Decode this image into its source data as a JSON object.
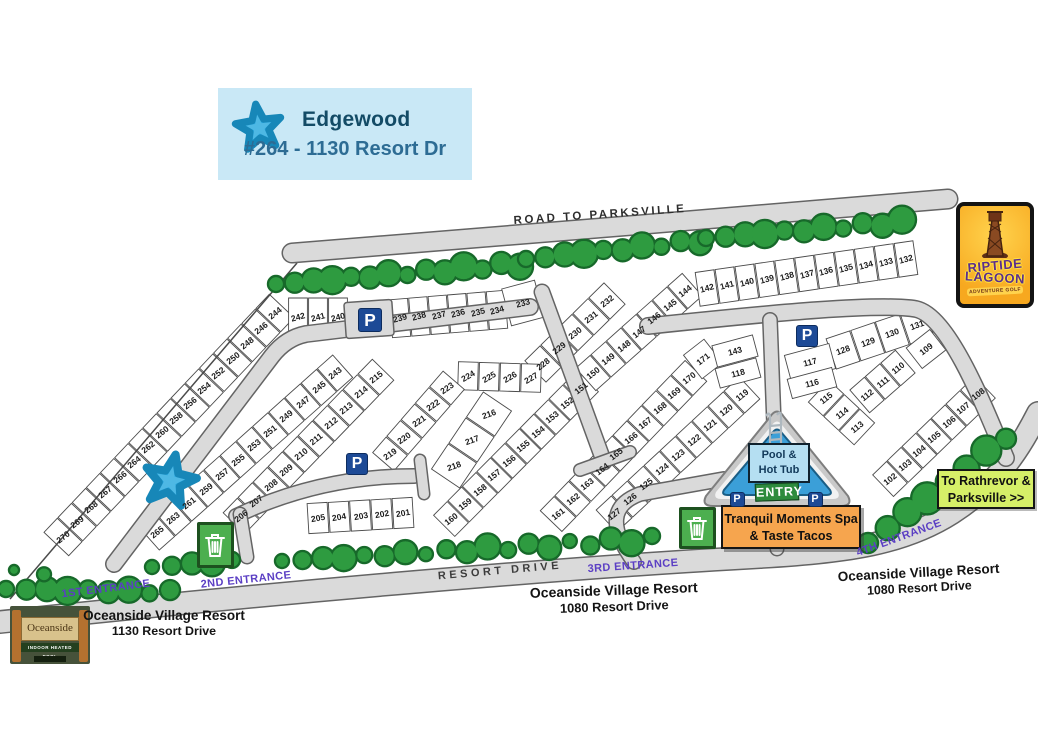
{
  "legend": {
    "name": "Edgewood",
    "unit": "#264 - 1130 Resort Dr"
  },
  "road_labels": {
    "top": "ROAD TO PARKSVILLE",
    "bottom": "RESORT DRIVE"
  },
  "entrances": [
    {
      "label": "1ST ENTRANCE",
      "x": 106,
      "y": 589,
      "rot": -7
    },
    {
      "label": "2ND ENTRANCE",
      "x": 246,
      "y": 580,
      "rot": -6
    },
    {
      "label": "3RD ENTRANCE",
      "x": 633,
      "y": 566,
      "rot": -4
    },
    {
      "label": "4TH ENTRANCE",
      "x": 899,
      "y": 538,
      "rot": -20
    }
  ],
  "addresses": [
    {
      "line1": "Oceanside Village Resort",
      "line2": "1130 Resort Drive",
      "x": 164,
      "y": 608,
      "rot": 0,
      "size": 13.5
    },
    {
      "line1": "Oceanside Village Resort",
      "line2": "1080 Resort Drive",
      "x": 614,
      "y": 582,
      "rot": -2,
      "size": 14
    },
    {
      "line1": "Oceanside Village Resort",
      "line2": "1080 Resort Drive",
      "x": 919,
      "y": 565,
      "rot": -3,
      "size": 13.5
    }
  ],
  "signs": {
    "entry": {
      "label": "ENTRY"
    },
    "pool": {
      "line1": "Pool &",
      "line2": "Hot Tub"
    },
    "spa": {
      "line1": "Tranquil Moments Spa",
      "line2": "& Taste Tacos"
    },
    "rathrevor": {
      "line1": "To Rathrevor &",
      "line2": "Parksville >>"
    },
    "riptide": {
      "line1": "RIPTIDE",
      "line2": "LAGOON",
      "line3": "ADVENTURE GOLF"
    },
    "oceanside_photo": {
      "title": "Oceanside",
      "line2": "INDOOR HEATED POOL"
    }
  },
  "strips": [
    {
      "id": "outer-west",
      "x1": 275,
      "y1": 313,
      "x2": 63,
      "y2": 537,
      "depth": 34,
      "rot": -38,
      "lots": [
        "244",
        "246",
        "248",
        "250",
        "252",
        "254",
        "256",
        "258",
        "260",
        "262",
        "264",
        "266",
        "267",
        "268",
        "269",
        "270"
      ]
    },
    {
      "id": "inner-west",
      "x1": 335,
      "y1": 373,
      "x2": 157,
      "y2": 532,
      "depth": 30,
      "rot": -38,
      "lots": [
        "243",
        "245",
        "247",
        "249",
        "251",
        "253",
        "255",
        "257",
        "259",
        "261",
        "263",
        "265"
      ]
    },
    {
      "id": "island-east",
      "x1": 376,
      "y1": 377,
      "x2": 241,
      "y2": 516,
      "depth": 30,
      "rot": -38,
      "lots": [
        "215",
        "214",
        "213",
        "212",
        "211",
        "210",
        "209",
        "208",
        "207",
        "206"
      ]
    },
    {
      "id": "top-row-a",
      "x1": 298,
      "y1": 317,
      "x2": 338,
      "y2": 317,
      "depth": 38,
      "rot": -15,
      "lots": [
        "242",
        "241",
        "240"
      ]
    },
    {
      "id": "top-row-b",
      "x1": 400,
      "y1": 318,
      "x2": 497,
      "y2": 310,
      "depth": 38,
      "rot": -15,
      "lots": [
        "239",
        "238",
        "237",
        "236",
        "235",
        "234"
      ]
    },
    {
      "id": "mid-230s",
      "x1": 607,
      "y1": 301,
      "x2": 543,
      "y2": 364,
      "depth": 30,
      "rot": -38,
      "lots": [
        "232",
        "231",
        "230",
        "229",
        "228"
      ]
    },
    {
      "id": "mid-220s-row",
      "x1": 468,
      "y1": 376,
      "x2": 531,
      "y2": 378,
      "depth": 28,
      "rot": -30,
      "lots": [
        "224",
        "225",
        "226",
        "227"
      ]
    },
    {
      "id": "mid-220s-diag",
      "x1": 447,
      "y1": 388,
      "x2": 390,
      "y2": 454,
      "depth": 28,
      "rot": -35,
      "lots": [
        "223",
        "222",
        "221",
        "220",
        "219"
      ]
    },
    {
      "id": "mid-216",
      "x1": 489,
      "y1": 414,
      "x2": 454,
      "y2": 466,
      "depth": 34,
      "rot": -20,
      "lots": [
        "216",
        "217",
        "218"
      ]
    },
    {
      "id": "strip-150s",
      "x1": 581,
      "y1": 388,
      "x2": 451,
      "y2": 519,
      "depth": 30,
      "rot": -38,
      "lots": [
        "151",
        "152",
        "153",
        "154",
        "155",
        "156",
        "157",
        "158",
        "159",
        "160"
      ]
    },
    {
      "id": "strip-140s",
      "x1": 685,
      "y1": 291,
      "x2": 593,
      "y2": 373,
      "depth": 30,
      "rot": -38,
      "lots": [
        "144",
        "145",
        "146",
        "147",
        "148",
        "149",
        "150"
      ]
    },
    {
      "id": "strip-160s",
      "x1": 689,
      "y1": 378,
      "x2": 558,
      "y2": 514,
      "depth": 30,
      "rot": -38,
      "lots": [
        "170",
        "169",
        "168",
        "167",
        "166",
        "165",
        "164",
        "163",
        "162",
        "161"
      ]
    },
    {
      "id": "strip-120s",
      "x1": 742,
      "y1": 395,
      "x2": 614,
      "y2": 514,
      "depth": 30,
      "rot": -38,
      "lots": [
        "119",
        "120",
        "121",
        "122",
        "123",
        "124",
        "125",
        "126",
        "127"
      ]
    },
    {
      "id": "strip-115",
      "x1": 826,
      "y1": 398,
      "x2": 857,
      "y2": 427,
      "depth": 30,
      "rot": -38,
      "lots": [
        "115",
        "114",
        "113"
      ]
    },
    {
      "id": "strip-112",
      "x1": 867,
      "y1": 395,
      "x2": 898,
      "y2": 368,
      "depth": 30,
      "rot": -38,
      "lots": [
        "112",
        "111",
        "110"
      ]
    },
    {
      "id": "strip-128",
      "x1": 843,
      "y1": 350,
      "x2": 917,
      "y2": 325,
      "depth": 32,
      "rot": -20,
      "lots": [
        "128",
        "129",
        "130",
        "131"
      ]
    },
    {
      "id": "strip-102s",
      "x1": 978,
      "y1": 394,
      "x2": 890,
      "y2": 479,
      "depth": 30,
      "rot": -38,
      "lots": [
        "108",
        "107",
        "106",
        "105",
        "104",
        "103",
        "102"
      ]
    },
    {
      "id": "bottom-200s",
      "x1": 318,
      "y1": 518,
      "x2": 403,
      "y2": 513,
      "depth": 30,
      "rot": -10,
      "lots": [
        "205",
        "204",
        "203",
        "202",
        "201"
      ]
    },
    {
      "id": "top-right-row",
      "x1": 707,
      "y1": 288,
      "x2": 906,
      "y2": 259,
      "depth": 34,
      "rot": -15,
      "lots": [
        "142",
        "141",
        "140",
        "139",
        "138",
        "137",
        "136",
        "135",
        "134",
        "133",
        "132"
      ]
    }
  ],
  "single_lots": [
    {
      "n": "233",
      "x": 523,
      "y": 303,
      "rot": -15,
      "w": 34,
      "h": 38
    },
    {
      "n": "171",
      "x": 703,
      "y": 359,
      "rot": -38,
      "w": 26,
      "h": 30
    },
    {
      "n": "143",
      "x": 735,
      "y": 351,
      "rot": -15,
      "w": 42,
      "h": 22
    },
    {
      "n": "118",
      "x": 738,
      "y": 373,
      "rot": -15,
      "w": 42,
      "h": 20
    },
    {
      "n": "117",
      "x": 810,
      "y": 362,
      "rot": -15,
      "w": 46,
      "h": 26
    },
    {
      "n": "116",
      "x": 812,
      "y": 383,
      "rot": -15,
      "w": 46,
      "h": 20
    },
    {
      "n": "109",
      "x": 926,
      "y": 349,
      "rot": -38,
      "w": 30,
      "h": 26
    }
  ],
  "parking": [
    {
      "x": 370,
      "y": 320,
      "s": 24
    },
    {
      "x": 357,
      "y": 464,
      "s": 22
    },
    {
      "x": 807,
      "y": 336,
      "s": 22
    },
    {
      "x": 737,
      "y": 499,
      "s": 15
    },
    {
      "x": 815,
      "y": 499,
      "s": 15
    }
  ],
  "trash": [
    {
      "x": 215,
      "y": 545,
      "w": 37,
      "h": 46
    },
    {
      "x": 697,
      "y": 528,
      "w": 37,
      "h": 42
    }
  ],
  "starfish": {
    "map": {
      "x": 170,
      "y": 481,
      "r": 27,
      "rot": 12
    },
    "legend": {
      "r": 24,
      "rot": -8
    }
  },
  "trees": [
    {
      "x1": 276,
      "y1": 284,
      "x2": 520,
      "y2": 264,
      "n": 14,
      "r": 11
    },
    {
      "x1": 526,
      "y1": 259,
      "x2": 700,
      "y2": 241,
      "n": 10,
      "r": 11
    },
    {
      "x1": 706,
      "y1": 238,
      "x2": 902,
      "y2": 222,
      "n": 11,
      "r": 11
    },
    {
      "x1": 6,
      "y1": 589,
      "x2": 170,
      "y2": 592,
      "n": 9,
      "r": 11
    },
    {
      "x1": 14,
      "y1": 570,
      "x2": 44,
      "y2": 574,
      "n": 2,
      "r": 8
    },
    {
      "x1": 152,
      "y1": 567,
      "x2": 232,
      "y2": 561,
      "n": 5,
      "r": 10
    },
    {
      "x1": 282,
      "y1": 561,
      "x2": 652,
      "y2": 539,
      "n": 19,
      "r": 10
    },
    {
      "x1": 868,
      "y1": 543,
      "x2": 1006,
      "y2": 437,
      "n": 8,
      "r": 13
    }
  ],
  "colors": {
    "road": "#dadada",
    "road_edge": "#646464",
    "tree": "#2e9b40",
    "tree_edge": "#17692a",
    "purple": "#5b3fc4",
    "parking_navy": "#1d4a96",
    "header_bg": "#c9e8f6",
    "header_title": "#134b66",
    "header_sub": "#2d6c94",
    "spa_orange": "#f6a54e",
    "rathrevor_lime": "#d6ef68",
    "entry_green": "#2e8b3d",
    "trash_green": "#4caf4f",
    "pool_blue": "#3b9fd8",
    "star_blue": "#2ba7de"
  }
}
